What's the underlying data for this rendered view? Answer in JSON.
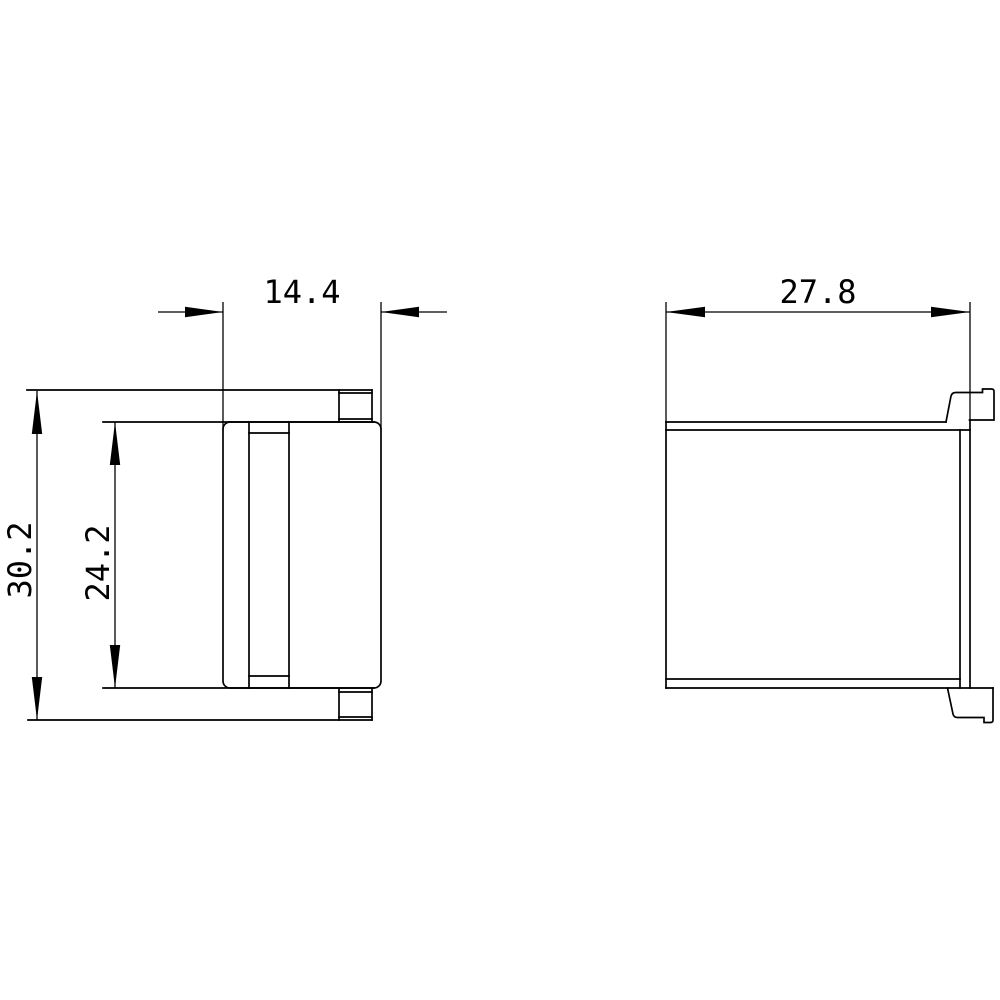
{
  "drawing": {
    "type": "technical-dimension-drawing",
    "background_color": "#ffffff",
    "line_color": "#000000",
    "views": {
      "side": {
        "dim_body_width": "14.4",
        "dim_overall_height": "30.2",
        "dim_inner_height": "24.2"
      },
      "front": {
        "dim_overall_width": "27.8"
      }
    }
  }
}
